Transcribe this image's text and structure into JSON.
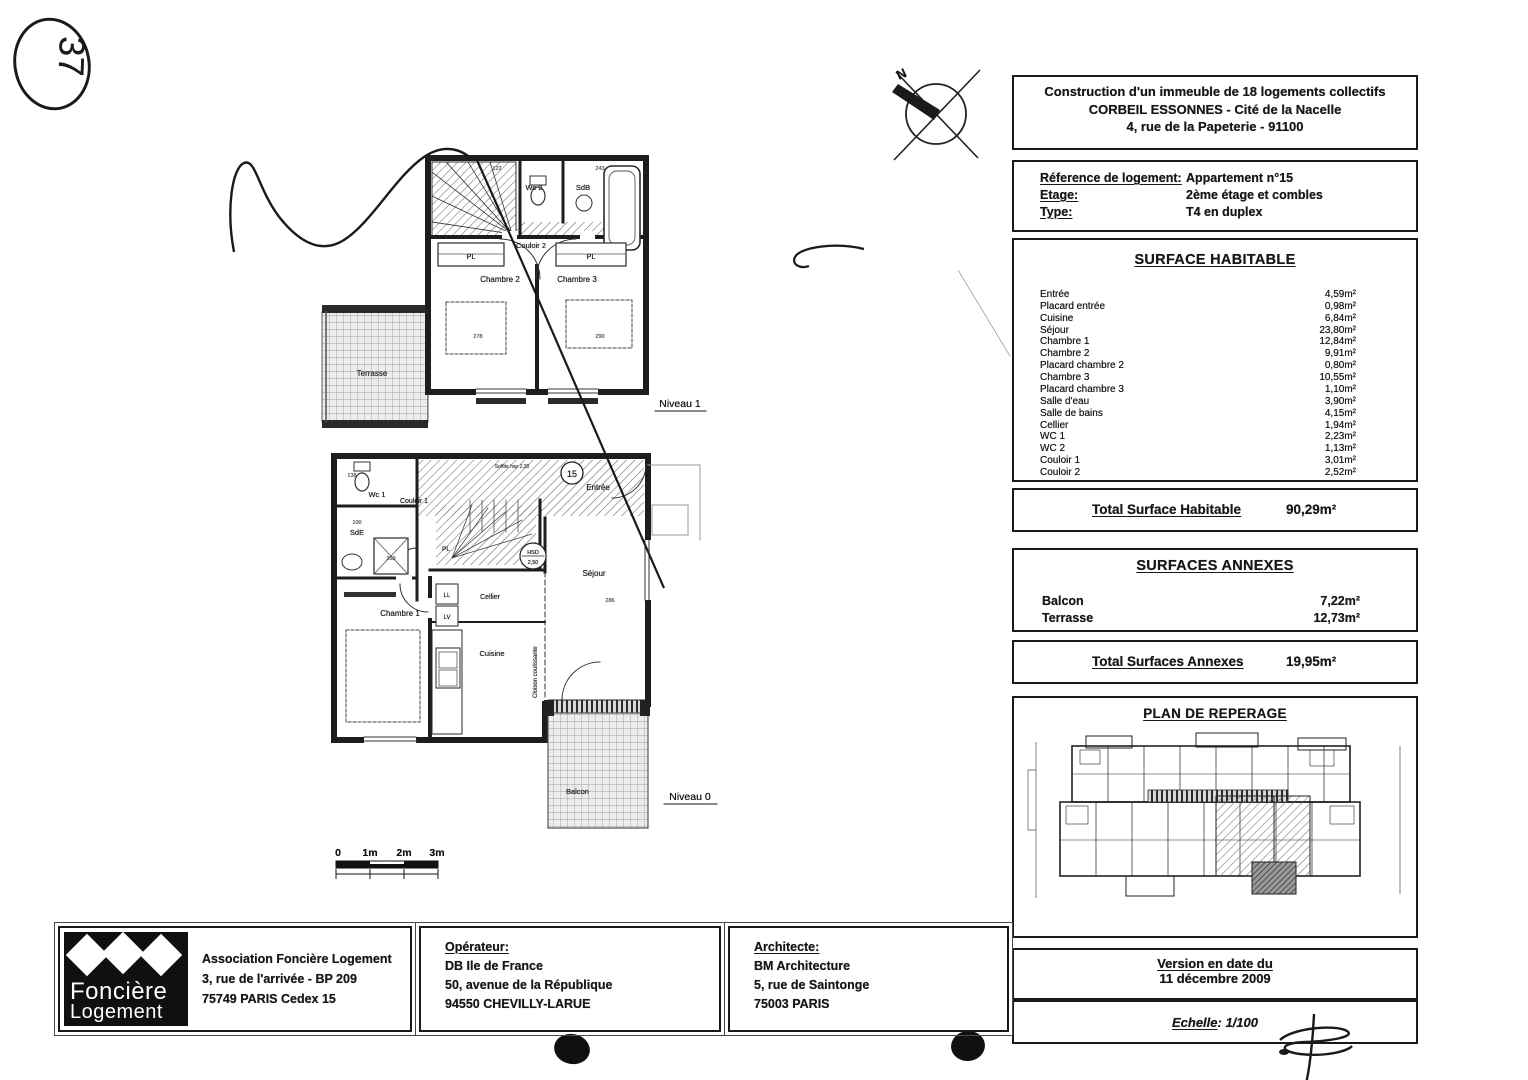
{
  "page": {
    "handwritten_number": "37"
  },
  "compass": {
    "label": "N"
  },
  "plans": {
    "scale": {
      "t0": "0",
      "t1": "1m",
      "t2": "2m",
      "t3": "3m"
    },
    "n1": {
      "niveau": "Niveau 1",
      "terrasse": "Terrasse",
      "wc2": "Wc 2",
      "sdb": "SdB",
      "couloir2": "Couloir 2",
      "pl_left": "PL",
      "pl_right": "PL",
      "chambre2": "Chambre 2",
      "chambre3": "Chambre 3",
      "dims": [
        "122",
        "243",
        "278",
        "290"
      ]
    },
    "n0": {
      "niveau": "Niveau 0",
      "wc1": "Wc 1",
      "couloir1": "Couloir 1",
      "sde": "SdE",
      "chambre1": "Chambre 1",
      "pl": "PL",
      "entree": "Entrée",
      "unit_number": "15",
      "sejour": "Séjour",
      "hsd1": "HSD",
      "hsd2": "2,50",
      "cellier": "Cellier",
      "ll": "LL",
      "lv": "LV",
      "cuisine": "Cuisine",
      "cloison": "Cloison coulissante",
      "balcon": "Balcon",
      "soffite": "Soffite hsp 2,20",
      "dims": [
        "138",
        "100",
        "253",
        "286"
      ]
    }
  },
  "header": {
    "line1": "Construction d'un immeuble de 18 logements collectifs",
    "line2": "CORBEIL ESSONNES - Cité de la Nacelle",
    "line3": "4, rue de la Papeterie - 91100"
  },
  "reference": {
    "rows": [
      {
        "label": "Réference de logement:",
        "value": "Appartement n°15"
      },
      {
        "label": "Etage:",
        "value": "2ème étage et combles"
      },
      {
        "label": "Type:",
        "value": "T4 en duplex"
      }
    ]
  },
  "surface_habitable": {
    "title": "SURFACE HABITABLE",
    "rows": [
      {
        "label": "Entrée",
        "value": "4,59m²"
      },
      {
        "label": "Placard entrée",
        "value": "0,98m²"
      },
      {
        "label": "Cuisine",
        "value": "6,84m²"
      },
      {
        "label": "Séjour",
        "value": "23,80m²"
      },
      {
        "label": "Chambre 1",
        "value": "12,84m²"
      },
      {
        "label": "Chambre 2",
        "value": "9,91m²"
      },
      {
        "label": "Placard chambre 2",
        "value": "0,80m²"
      },
      {
        "label": "Chambre 3",
        "value": "10,55m²"
      },
      {
        "label": "Placard chambre 3",
        "value": "1,10m²"
      },
      {
        "label": "Salle d'eau",
        "value": "3,90m²"
      },
      {
        "label": "Salle de bains",
        "value": "4,15m²"
      },
      {
        "label": "Cellier",
        "value": "1,94m²"
      },
      {
        "label": "WC 1",
        "value": "2,23m²"
      },
      {
        "label": "WC 2",
        "value": "1,13m²"
      },
      {
        "label": "Couloir 1",
        "value": "3,01m²"
      },
      {
        "label": "Couloir 2",
        "value": "2,52m²"
      }
    ]
  },
  "total_surface": {
    "label": "Total Surface Habitable",
    "value": "90,29m²"
  },
  "surfaces_annexes": {
    "title": "SURFACES ANNEXES",
    "rows": [
      {
        "label": "Balcon",
        "value": "7,22m²"
      },
      {
        "label": "Terrasse",
        "value": "12,73m²"
      }
    ]
  },
  "total_annexes": {
    "label": "Total Surfaces Annexes",
    "value": "19,95m²"
  },
  "reperage": {
    "title": "PLAN DE REPERAGE"
  },
  "version": {
    "label": "Version en date du",
    "date": "11 décembre 2009"
  },
  "echelle": {
    "label": "Echelle",
    "value": ": 1/100"
  },
  "footer": {
    "logo": {
      "line1": "Foncière",
      "line2": "Logement"
    },
    "association": {
      "line1": "Association Foncière Logement",
      "line2": "3, rue de l'arrivée - BP 209",
      "line3": "75749 PARIS Cedex 15"
    },
    "operateur": {
      "title": "Opérateur:",
      "line1": "DB Ile de France",
      "line2": "50, avenue de la République",
      "line3": "94550 CHEVILLY-LARUE"
    },
    "architecte": {
      "title": "Architecte:",
      "line1": "BM Architecture",
      "line2": "5, rue de Saintonge",
      "line3": "75003 PARIS"
    }
  }
}
